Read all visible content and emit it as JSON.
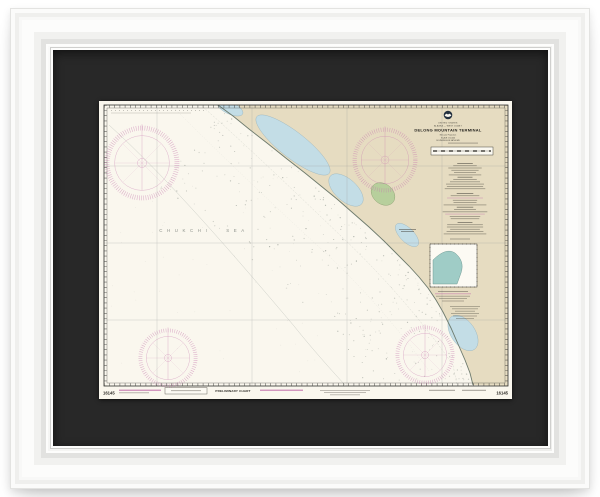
{
  "artwork": {
    "kind": "framed nautical chart print",
    "frame_color": "#f6f6f5",
    "mat_color": "#282828"
  },
  "chart": {
    "number": "16145",
    "country": "UNITED STATES",
    "region": "ALASKA — WEST COAST",
    "title": "DELONG MOUNTAIN TERMINAL",
    "subtitle1": "Mercator Projection",
    "subtitle2": "SCALE 1:50,000",
    "subtitle3": "SOUNDINGS IN FATHOMS",
    "sea_label": "CHUKCHI SEA",
    "preliminary": "PRELIMINARY CHART",
    "logo": "noaa-emblem",
    "colors": {
      "mat": "#282828",
      "frame": "#f6f6f5",
      "paper": "#faf7ee",
      "land": "#e6dcc1",
      "water": "#c3dde6",
      "inset": "#9fccc6",
      "green": "#b7cf9c",
      "magenta": "#c678ae",
      "grid": "#8c8c8c",
      "coast": "#6d7a6d"
    }
  }
}
